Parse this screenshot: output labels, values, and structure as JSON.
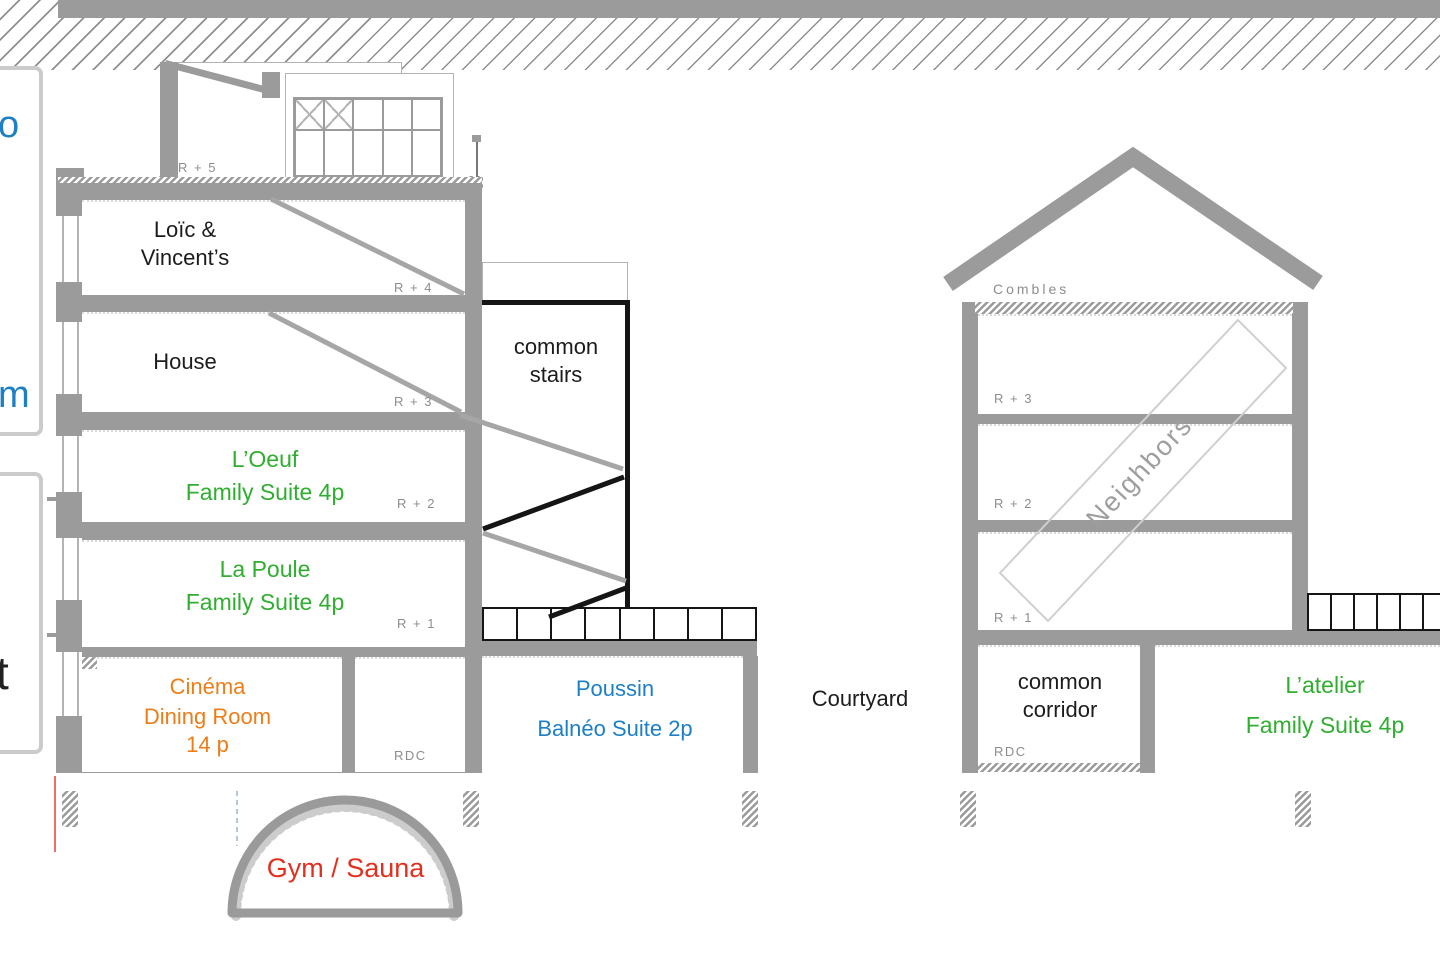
{
  "colors": {
    "suite_green": "#2fae2f",
    "dining_orange": "#ed7d17",
    "suite_blue": "#1d7fc4",
    "gym_red": "#e2301e",
    "wall_gray": "#9b9b9b"
  },
  "legend": {
    "letter_blue": "o",
    "letter_orange": "m",
    "letter_black": "t"
  },
  "left_building": {
    "r5_label": "R + 5",
    "r4_line1": "Loïc &",
    "r4_line2": "Vincent’s",
    "r4_level": "R + 4",
    "r3_line1": "House",
    "r3_level": "R + 3",
    "r2_line1": "L’Oeuf",
    "r2_line2": "Family Suite 4p",
    "r2_level": "R + 2",
    "r1_line1": "La Poule",
    "r1_line2": "Family Suite 4p",
    "r1_level": "R + 1",
    "rdc_line1": "Cinéma",
    "rdc_line2": "Dining Room",
    "rdc_line3": "14 p",
    "rdc_level": "RDC"
  },
  "stairs": {
    "line1": "common",
    "line2": "stairs"
  },
  "ground_floor": {
    "poussin_line1": "Poussin",
    "poussin_line2": "Balnéo Suite 2p",
    "courtyard": "Courtyard"
  },
  "right_building": {
    "attic_label": "Combles",
    "r3_level": "R + 3",
    "r2_level": "R + 2",
    "r1_level": "R + 1",
    "neighbors_label": "Neighbors",
    "corridor_line1": "common",
    "corridor_line2": "corridor",
    "rdc_level": "RDC",
    "atelier_line1": "L’atelier",
    "atelier_line2": "Family Suite 4p"
  },
  "basement": {
    "gym_label": "Gym / Sauna"
  }
}
